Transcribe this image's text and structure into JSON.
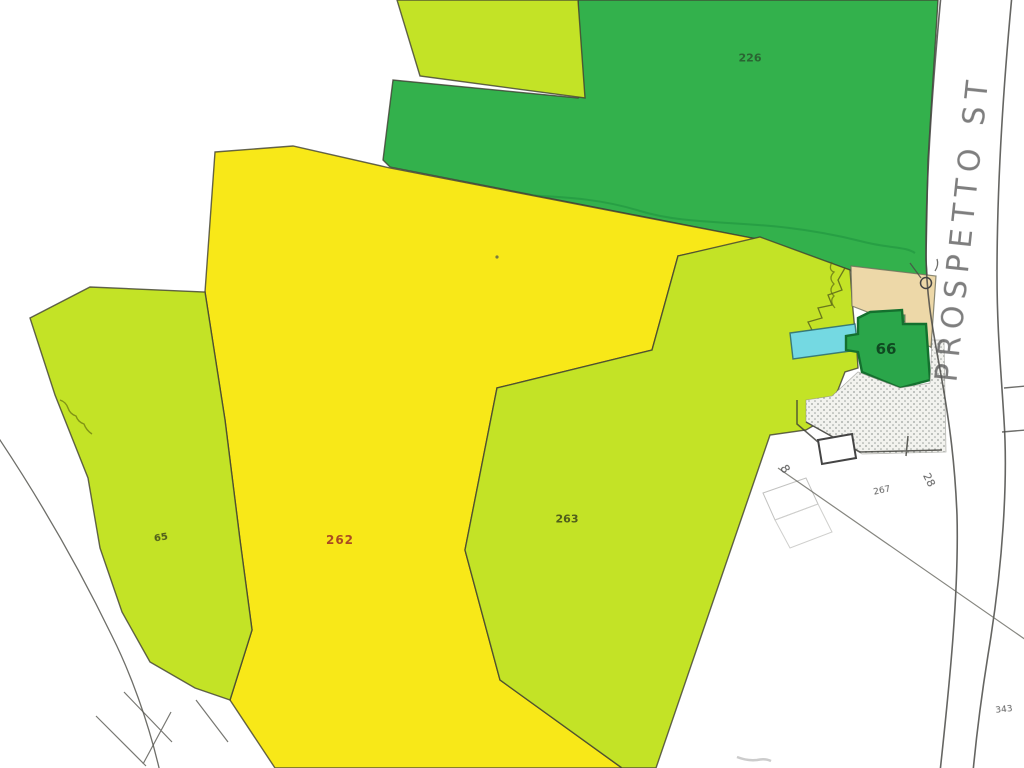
{
  "labels": {
    "p226": "226",
    "p262": "262",
    "p263": "263",
    "p65": "65",
    "p66": "66",
    "p267": "267",
    "p343": "343",
    "n28": "28",
    "n8": "8",
    "road": "PROSPETTO ST"
  },
  "colors": {
    "dark_green": "#33b14c",
    "light_green": "#c3e326",
    "yellow": "#f8e818",
    "tan": "#edd8a8",
    "cyan": "#74d9e2",
    "green66": "#2aa64a",
    "green66_border": "#14702e",
    "stipple_bg": "#f2f2ee",
    "stipple_dot": "#9aa09c",
    "boundary": "#3f3f32",
    "thin_line": "#5a5a55",
    "dark_label": "#2a5c30",
    "red_label": "#a23c22",
    "olive_label": "#44501a",
    "green_label": "#0d3f1d",
    "gray_label": "#4f4f4f",
    "road_label": "#5a5a5a"
  }
}
